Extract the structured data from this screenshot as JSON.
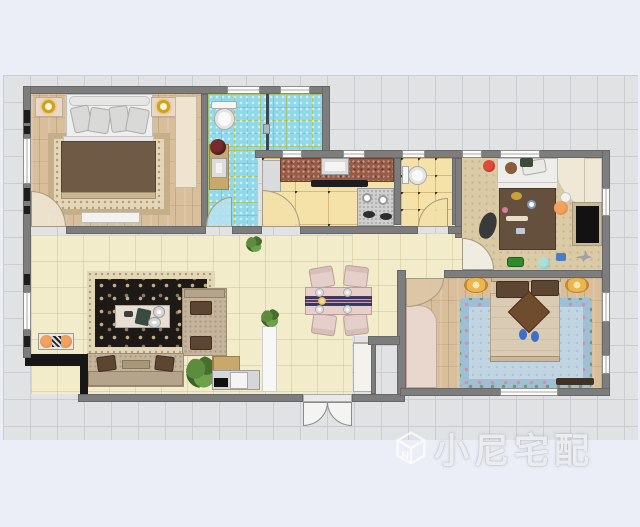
{
  "watermark": {
    "text": "小尼宅配",
    "logo_icon": "cube-n-logo-icon"
  },
  "palette": {
    "page_bg": "#EBEEF6",
    "canvas_bg": "#E0E2E4",
    "canvas_grid": "#C9CCD0",
    "wall": "#7D7D7D",
    "wood_floor": "#D8BE9A",
    "cream_floor": "#F2ECCA",
    "blue_tile": "#8FD9EA",
    "yellow_tile": "#F4E2A9",
    "kids_carpet": "#DACAA6",
    "rug_dark": "#1C1916",
    "rug_border": "#E3D7B8",
    "sofa_beige": "#C5B49C",
    "cushion_brown": "#5C4632",
    "duvet_brown": "#6F5A46",
    "dining_pink": "#E7D0CB",
    "master_rug_blue": "#C2D5E3",
    "wardrobe_pink": "#E9D6CD",
    "plant_green": "#5E8C3E",
    "accent_orange": "#E8833A",
    "watermark_color": "rgba(255,255,255,0.8)"
  }
}
